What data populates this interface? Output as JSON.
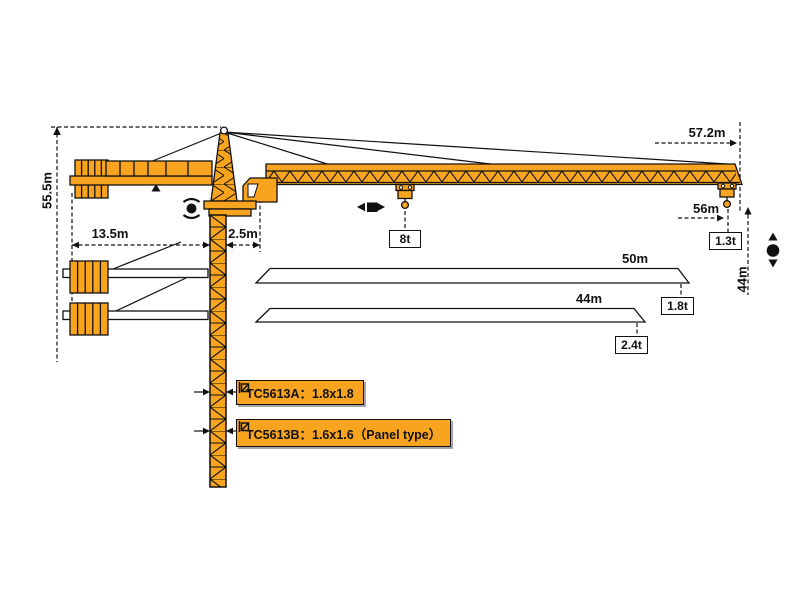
{
  "diagram": {
    "type": "tower-crane-specification-diagram",
    "colors": {
      "crane": "#F8A41F",
      "line": "#111111",
      "background": "#FFFFFF"
    },
    "dimensions": {
      "tower_height": "55.5m",
      "counterjib_radius": "13.5m",
      "rear_offset": "2.5m",
      "jib_overall": "57.2m",
      "max_radius": "56m",
      "hook_height": "44m"
    },
    "loads": {
      "max_load": "8t",
      "tip_load": "1.3t"
    },
    "jib_options": [
      {
        "length": "50m",
        "tip_load": "1.8t"
      },
      {
        "length": "44m",
        "tip_load": "2.4t"
      }
    ],
    "mast_options": [
      {
        "label": "TC5613A：1.8x1.8"
      },
      {
        "label": "TC5613B：1.6x1.6（Panel type）"
      }
    ],
    "symbols": [
      "slewing-rotation-icon",
      "trolley-travel-icon",
      "hoisting-icon",
      "mast-section-icon"
    ]
  }
}
